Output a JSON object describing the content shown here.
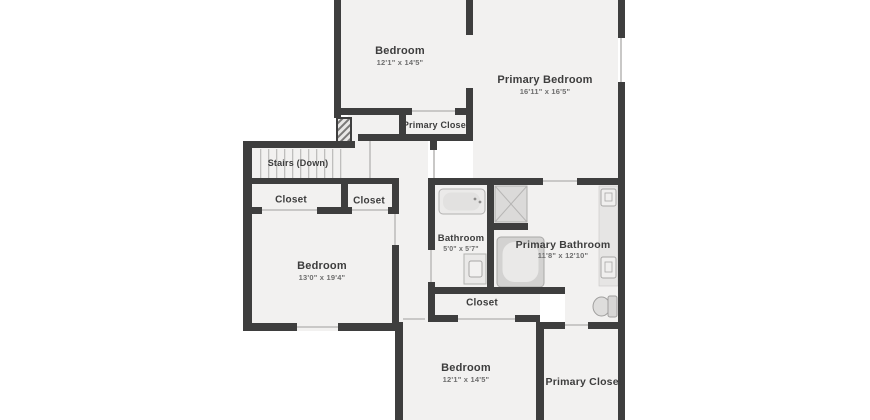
{
  "title": "Second floor plan",
  "colors": {
    "wall": "#3e3e3e",
    "room_fill": "#f2f1f0",
    "fixture_fill": "#e8e7e6",
    "door_line": "#c9c8c7",
    "label_text": "#3d3d3d",
    "dims_text": "#6e6e6e",
    "background": "#ffffff"
  },
  "rooms": {
    "bedroom_top": {
      "label": "Bedroom",
      "dims": "12'1\" x 14'5\""
    },
    "primary_bedroom": {
      "label": "Primary Bedroom",
      "dims": "16'11\" x 16'5\""
    },
    "primary_closet_top": {
      "label": "Primary Closet"
    },
    "stairs": {
      "label": "Stairs (Down)"
    },
    "closet_left": {
      "label": "Closet"
    },
    "closet_mid_left": {
      "label": "Closet"
    },
    "bedroom_left": {
      "label": "Bedroom",
      "dims": "13'0\" x 19'4\""
    },
    "bathroom": {
      "label": "Bathroom",
      "dims": "5'0\" x 5'7\""
    },
    "primary_bathroom": {
      "label": "Primary Bathroom",
      "dims": "11'8\" x 12'10\""
    },
    "closet_bottom_mid": {
      "label": "Closet"
    },
    "bedroom_bottom": {
      "label": "Bedroom",
      "dims": "12'1\" x 14'5\""
    },
    "primary_closet_bottom": {
      "label": "Primary Closet"
    }
  },
  "fixtures": [
    "bathtub",
    "shower",
    "soaking-tub",
    "vanity-sink",
    "vanity-sink",
    "bathroom-sink",
    "toilet",
    "stair-treads",
    "hatched-column"
  ]
}
